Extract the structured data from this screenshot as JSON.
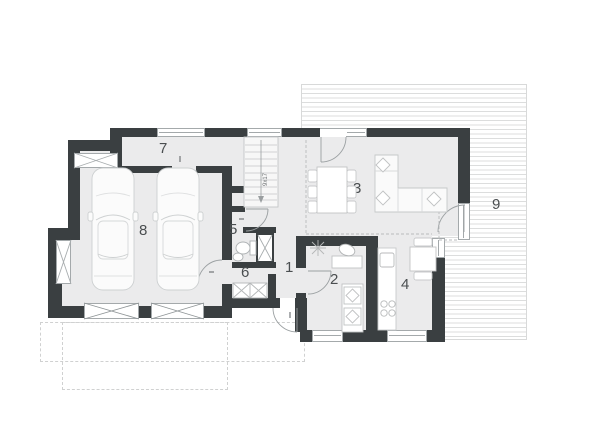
{
  "plan": {
    "type": "floor-plan",
    "colors": {
      "wall": "#3a3f41",
      "floor": "#ebebec",
      "terrace_stripe": "#dcdddd",
      "furniture_line": "#c6c8c9",
      "window_line": "#a4a9ab",
      "label": "#4a4e50"
    }
  },
  "rooms": [
    {
      "number": "1",
      "label": "1"
    },
    {
      "number": "2",
      "label": "2"
    },
    {
      "number": "3",
      "label": "3"
    },
    {
      "number": "4",
      "label": "4"
    },
    {
      "number": "5",
      "label": "5"
    },
    {
      "number": "6",
      "label": "6"
    },
    {
      "number": "7",
      "label": "7"
    },
    {
      "number": "8",
      "label": "8"
    },
    {
      "number": "9",
      "label": "9"
    }
  ],
  "stairs": {
    "annotation": "9x17"
  }
}
